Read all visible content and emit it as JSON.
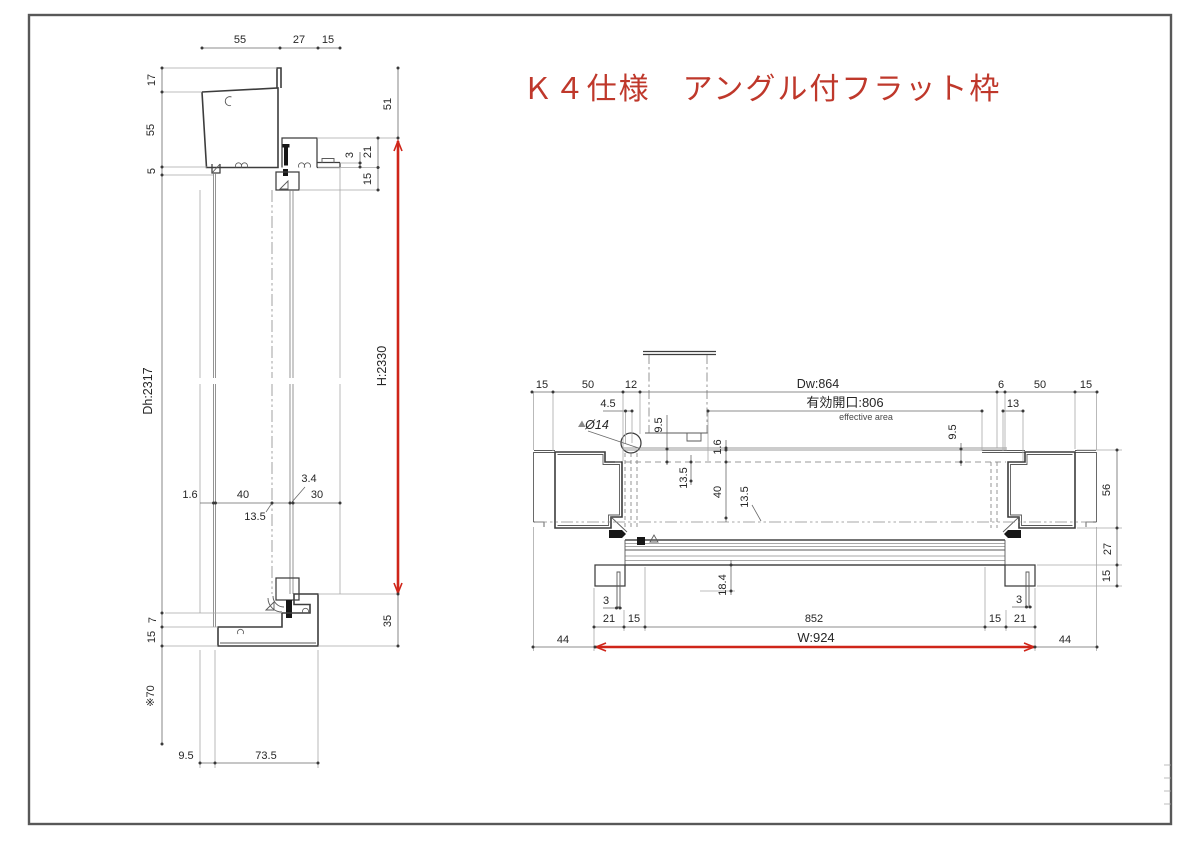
{
  "title": "Ｋ４仕様　アングル付フラット枠",
  "colors": {
    "accent_red": "#cf2519",
    "title_red": "#bf382b",
    "profile_line": "#3d3d3d",
    "dim_line": "#6a6a6a",
    "light_line": "#a8a8a8"
  },
  "left_section": {
    "top_dims": [
      "55",
      "27",
      "15"
    ],
    "side_dims": [
      "17",
      "55",
      "5"
    ],
    "right_top_dim": "51",
    "right_dims": [
      "3",
      "21",
      "15"
    ],
    "height": "H:2330",
    "door_height": "Dh:2317",
    "mid_dims": [
      "1.6",
      "40",
      "3.4",
      "30",
      "13.5"
    ],
    "bottom_side_dims": [
      "7",
      "15"
    ],
    "wall_note": "※70",
    "bottom_right_dim": "35",
    "bottom_dims": [
      "9.5",
      "73.5"
    ]
  },
  "right_section": {
    "top_left_dims": [
      "15",
      "50",
      "12"
    ],
    "top_right_dims": [
      "6",
      "50",
      "15"
    ],
    "door_width": "Dw:864",
    "effective_opening": "有効開口:806",
    "effective_opening_en": "effective area",
    "hinge_dia": "Ø14",
    "dim_4_5": "4.5",
    "dim_9_5_left": "9.5",
    "dim_1_6": "1.6",
    "dim_13_5_a": "13.5",
    "dim_40": "40",
    "dim_13_5_b": "13.5",
    "dim_9_5_right": "9.5",
    "dim_13": "13",
    "right_side_dims": [
      "56",
      "27",
      "15"
    ],
    "dim_18_4": "18.4",
    "dim_3_left": "3",
    "bottom_left_dims": [
      "21",
      "15"
    ],
    "dim_852": "852",
    "bottom_right_dims": [
      "15",
      "21"
    ],
    "dim_3_right": "3",
    "width": "W:924",
    "dim_44_left": "44",
    "dim_44_right": "44"
  }
}
